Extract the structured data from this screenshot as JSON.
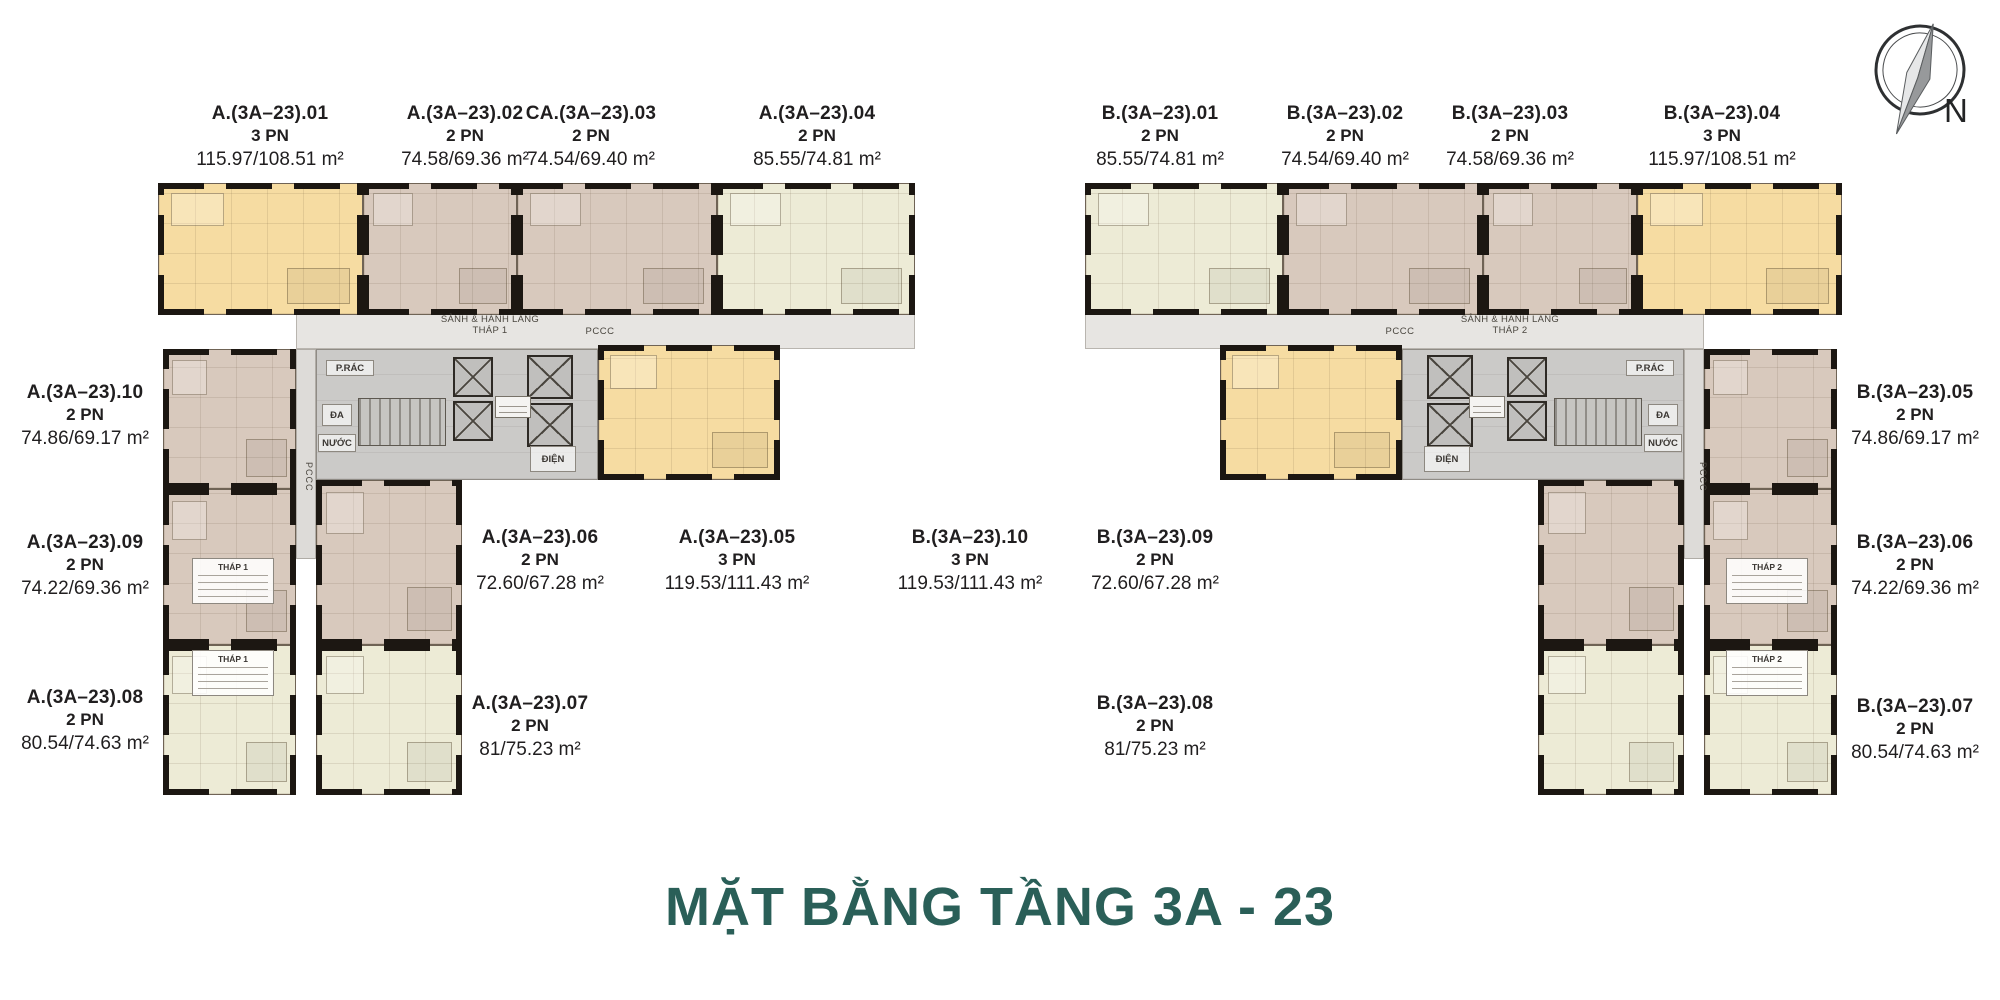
{
  "title": "MẶT BẰNG TẦNG 3A - 23",
  "compass": {
    "label": "N"
  },
  "colors": {
    "title_teal": "#2A5F58",
    "unit_yellow": "#F6DCA2",
    "unit_tan": "#D8C9BD",
    "unit_cream": "#EDEBD6",
    "corridor_gray": "#E7E5E2",
    "core_gray": "#CBCAC8",
    "wall_black": "#1C1712"
  },
  "towers": [
    {
      "core_labels": {
        "lobby1": "SẢNH & HÀNH LANG",
        "lobby2": "THÁP 1",
        "pccc": "PCCC",
        "pccc_side": "PCCC",
        "dien": "ĐIỆN",
        "prac": "P.RÁC",
        "da": "ĐA",
        "nuoc": "NƯỚC",
        "legend": "THÁP 1"
      },
      "units": [
        {
          "id": "A.(3A–23).01",
          "bedrooms": "3 PN",
          "area": "115.97/108.51 m²"
        },
        {
          "id": "A.(3A–23).02",
          "bedrooms": "2 PN",
          "area": "74.58/69.36 m²"
        },
        {
          "id": "CA.(3A–23).03",
          "bedrooms": "2 PN",
          "area": "74.54/69.40 m²"
        },
        {
          "id": "A.(3A–23).04",
          "bedrooms": "2 PN",
          "area": "85.55/74.81 m²"
        },
        {
          "id": "A.(3A–23).05",
          "bedrooms": "3 PN",
          "area": "119.53/111.43 m²"
        },
        {
          "id": "A.(3A–23).06",
          "bedrooms": "2 PN",
          "area": "72.60/67.28 m²"
        },
        {
          "id": "A.(3A–23).07",
          "bedrooms": "2 PN",
          "area": "81/75.23 m²"
        },
        {
          "id": "A.(3A–23).08",
          "bedrooms": "2 PN",
          "area": "80.54/74.63 m²"
        },
        {
          "id": "A.(3A–23).09",
          "bedrooms": "2 PN",
          "area": "74.22/69.36 m²"
        },
        {
          "id": "A.(3A–23).10",
          "bedrooms": "2 PN",
          "area": "74.86/69.17 m²"
        }
      ]
    },
    {
      "core_labels": {
        "lobby1": "SẢNH & HÀNH LANG",
        "lobby2": "THÁP 2",
        "pccc": "PCCC",
        "pccc_side": "PCCC",
        "dien": "ĐIỆN",
        "prac": "P.RÁC",
        "da": "ĐA",
        "nuoc": "NƯỚC",
        "legend": "THÁP 2"
      },
      "units": [
        {
          "id": "B.(3A–23).01",
          "bedrooms": "2 PN",
          "area": "85.55/74.81 m²"
        },
        {
          "id": "B.(3A–23).02",
          "bedrooms": "2 PN",
          "area": "74.54/69.40 m²"
        },
        {
          "id": "B.(3A–23).03",
          "bedrooms": "2 PN",
          "area": "74.58/69.36 m²"
        },
        {
          "id": "B.(3A–23).04",
          "bedrooms": "3 PN",
          "area": "115.97/108.51 m²"
        },
        {
          "id": "B.(3A–23).05",
          "bedrooms": "2 PN",
          "area": "74.86/69.17 m²"
        },
        {
          "id": "B.(3A–23).06",
          "bedrooms": "2 PN",
          "area": "74.22/69.36 m²"
        },
        {
          "id": "B.(3A–23).07",
          "bedrooms": "2 PN",
          "area": "80.54/74.63 m²"
        },
        {
          "id": "B.(3A–23).08",
          "bedrooms": "2 PN",
          "area": "81/75.23 m²"
        },
        {
          "id": "B.(3A–23).09",
          "bedrooms": "2 PN",
          "area": "72.60/67.28 m²"
        },
        {
          "id": "B.(3A–23).10",
          "bedrooms": "3 PN",
          "area": "119.53/111.43 m²"
        }
      ]
    }
  ]
}
